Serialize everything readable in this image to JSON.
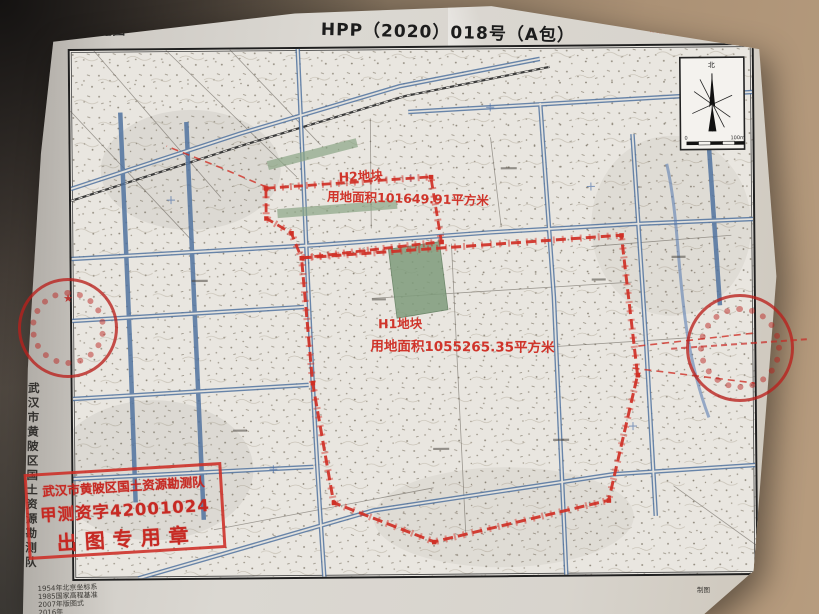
{
  "colors": {
    "paper": "#d8d4cd",
    "map_background": "#e9e6e0",
    "road_blue": "#51739f",
    "boundary_red": "#cf3026",
    "stamp_red": "#c62620",
    "green_area": "#7f9c7c",
    "ink_black": "#1f1f1f",
    "photo_table_tan": "#b79c7e"
  },
  "header": {
    "corner_label": "宗地图",
    "title": "HPP（2020）018号（A包）",
    "doc_number": "陵供2020第14号"
  },
  "parcels": {
    "h2": {
      "name": "H2地块",
      "area": "用地面积101649.91平方米"
    },
    "h1": {
      "name": "H1地块",
      "area": "用地面积1055265.35平方米"
    }
  },
  "compass": {
    "north_label": "北",
    "scale_zero": "0",
    "scale_end": "100m"
  },
  "stamp": {
    "line1": "武汉市黄陂区国土资源勘测队",
    "line2": "甲测资字42001024",
    "line3": "出图专用章"
  },
  "margin": {
    "left_vertical_text": "武汉市黄陂区国土资源勘测队",
    "credit": "制图"
  },
  "notes": {
    "lines": [
      "1954年北京坐标系",
      "1985国家高程基准",
      "2007年版图式",
      "2016年"
    ]
  }
}
